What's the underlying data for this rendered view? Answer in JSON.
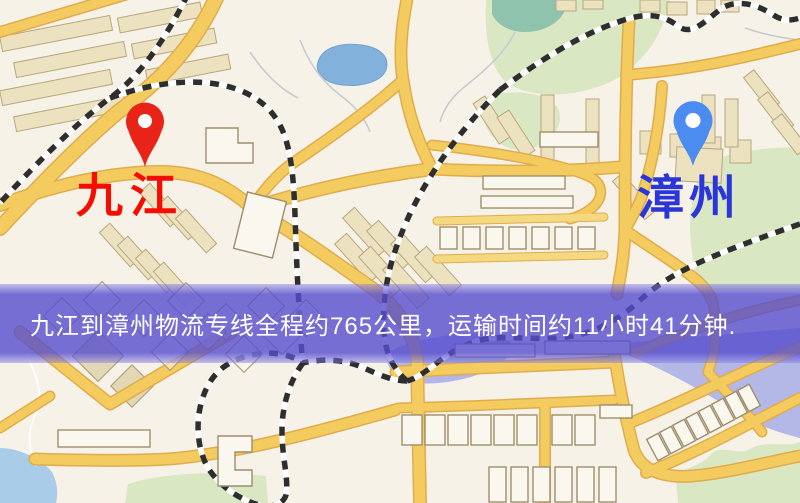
{
  "banner": {
    "text": "九江到漳州物流专线全程约765公里，运输时间约11小时41分钟.",
    "background_color": "#564DCE",
    "text_color": "#FFFFFF"
  },
  "markers": [
    {
      "id": "origin",
      "label": "九江",
      "pin_color": "#E82418",
      "label_color": "#F50E00",
      "pin_style": "red-teardrop"
    },
    {
      "id": "destination",
      "label": "漳州",
      "pin_color": "#4C8CF0",
      "label_color": "#2B36D9",
      "pin_style": "blue-teardrop"
    }
  ],
  "route_info": {
    "origin": "九江",
    "destination": "漳州",
    "distance_km": "765",
    "duration_hours": "11",
    "duration_minutes": "41"
  },
  "map": {
    "type": "street-map",
    "palette": {
      "background": "#F7F2E8",
      "road_fill": "#F4CB5F",
      "road_casing": "#E0AC4D",
      "minor_road": "#F5D981",
      "park": "#D9E7C2",
      "water_lake": "#82B2DC",
      "water_pond": "#8FC3AE",
      "water_river": "#A9AEE4",
      "water_shore": "#A9CCE8",
      "building_fill": "#EDE2C0",
      "building_outline": "#9E8E6C",
      "railway_dark": "#2E2E2E",
      "railway_light": "#FFFFFF"
    },
    "features": [
      "roads",
      "railways",
      "buildings",
      "parks",
      "lakes",
      "streams"
    ]
  }
}
